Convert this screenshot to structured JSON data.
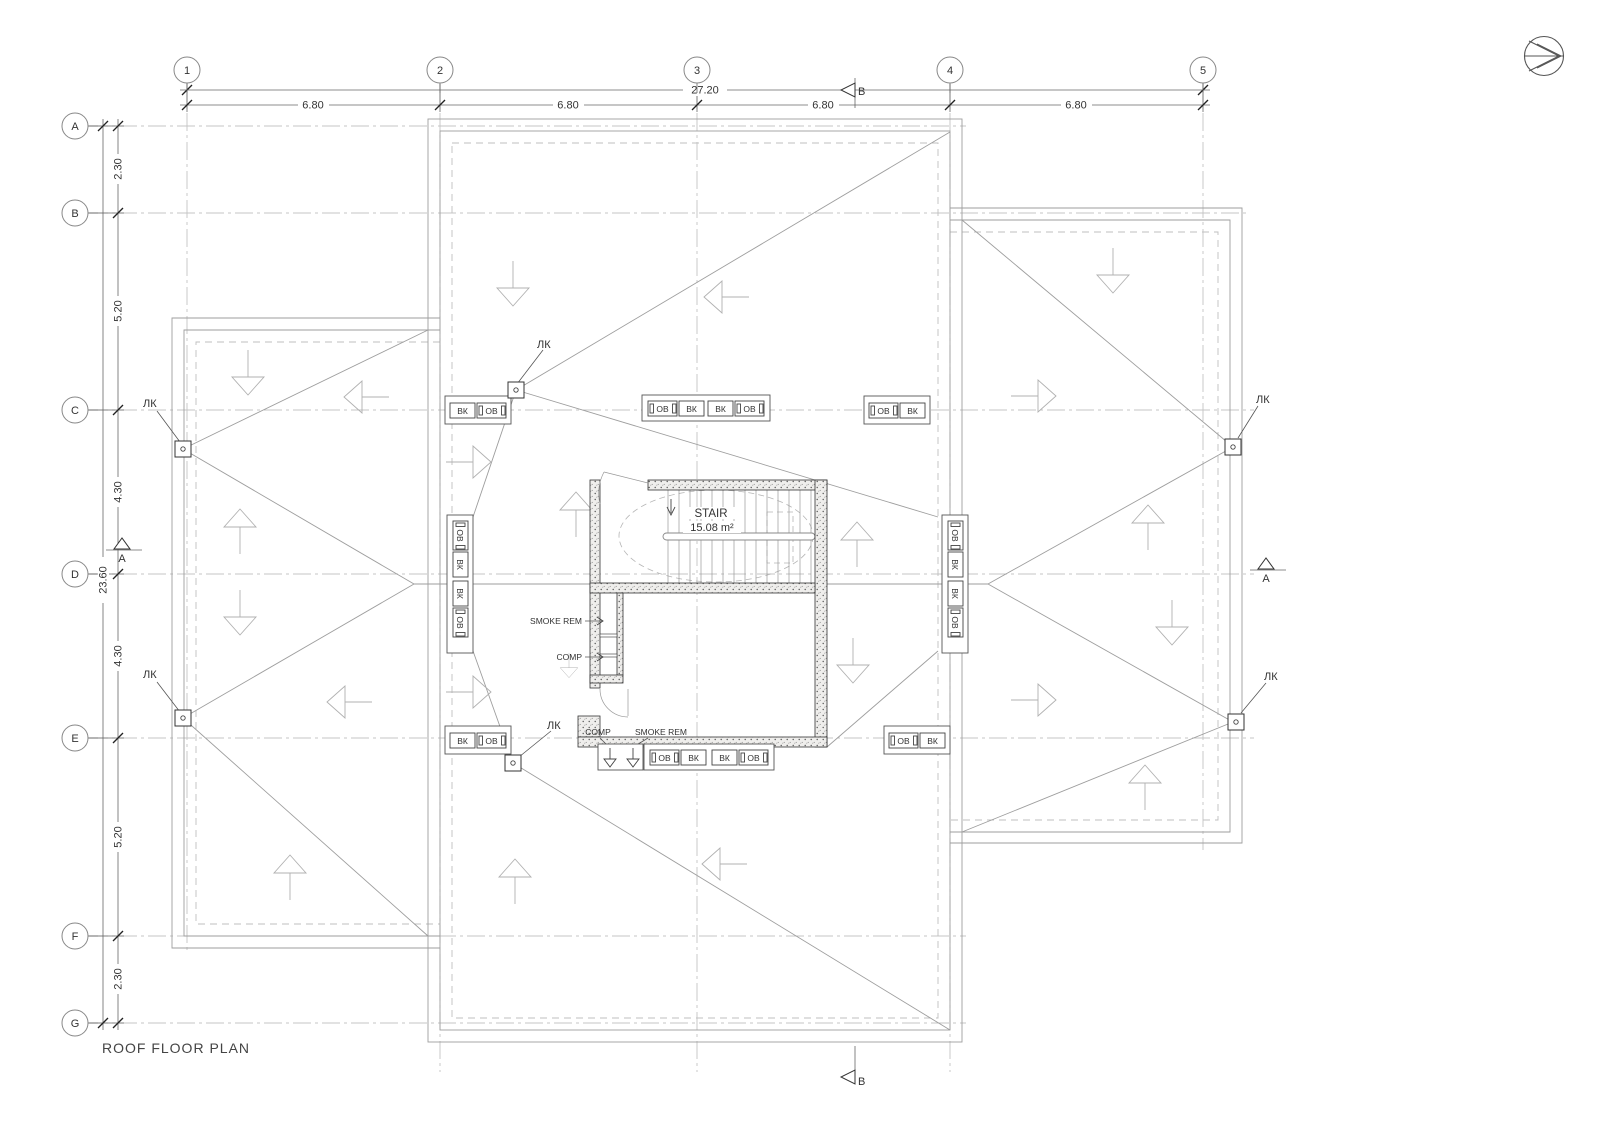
{
  "page": {
    "title": "ROOF FLOOR PLAN"
  },
  "grid": {
    "cols": [
      "1",
      "2",
      "3",
      "4",
      "5"
    ],
    "rows": [
      "A",
      "B",
      "C",
      "D",
      "E",
      "F",
      "G"
    ]
  },
  "dims": {
    "top_total": "27.20",
    "top": [
      "6.80",
      "6.80",
      "6.80",
      "6.80"
    ],
    "left_total": "23.60",
    "left": [
      "2.30",
      "5.20",
      "4.30",
      "4.30",
      "5.20",
      "2.30"
    ]
  },
  "sections": {
    "a": "A",
    "b": "B"
  },
  "stair": {
    "label": "STAIR",
    "area": "15.08 m²"
  },
  "ducts": {
    "smoke": "SMOKE REM",
    "comp": "COMP"
  },
  "vents": {
    "vk": "ВК",
    "ov": "ОВ"
  },
  "marks": {
    "lk": "ЛК"
  },
  "colors": {
    "line": "#9e9e9e",
    "grid": "#c4c4c4",
    "wall": "#333333",
    "text": "#333333"
  }
}
